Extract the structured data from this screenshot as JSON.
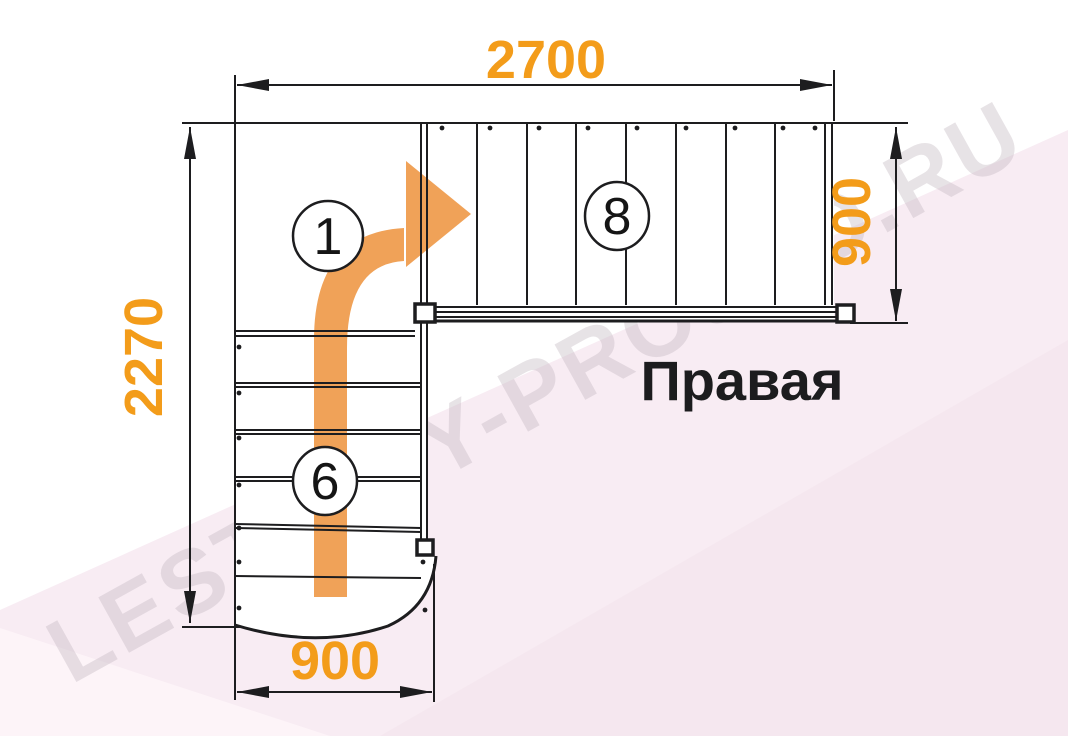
{
  "diagram": {
    "type": "staircase-floor-plan",
    "title": "Правая",
    "watermark": "LESTNICY-PROSTO.RU",
    "dimensions": {
      "top": "2700",
      "left": "2270",
      "right": "900",
      "bottom": "900"
    },
    "markers": [
      {
        "id": "route-step",
        "label": "1"
      },
      {
        "id": "upper-flight-steps",
        "label": "8"
      },
      {
        "id": "lower-flight-steps",
        "label": "6"
      }
    ],
    "colors": {
      "dimension_text": "#f39c1a",
      "direction_arrow": "#f0a258",
      "drawing_line": "#1d1d1f",
      "background_pink": "#f8ecf3",
      "watermark_gray": "#c5bac3"
    }
  }
}
